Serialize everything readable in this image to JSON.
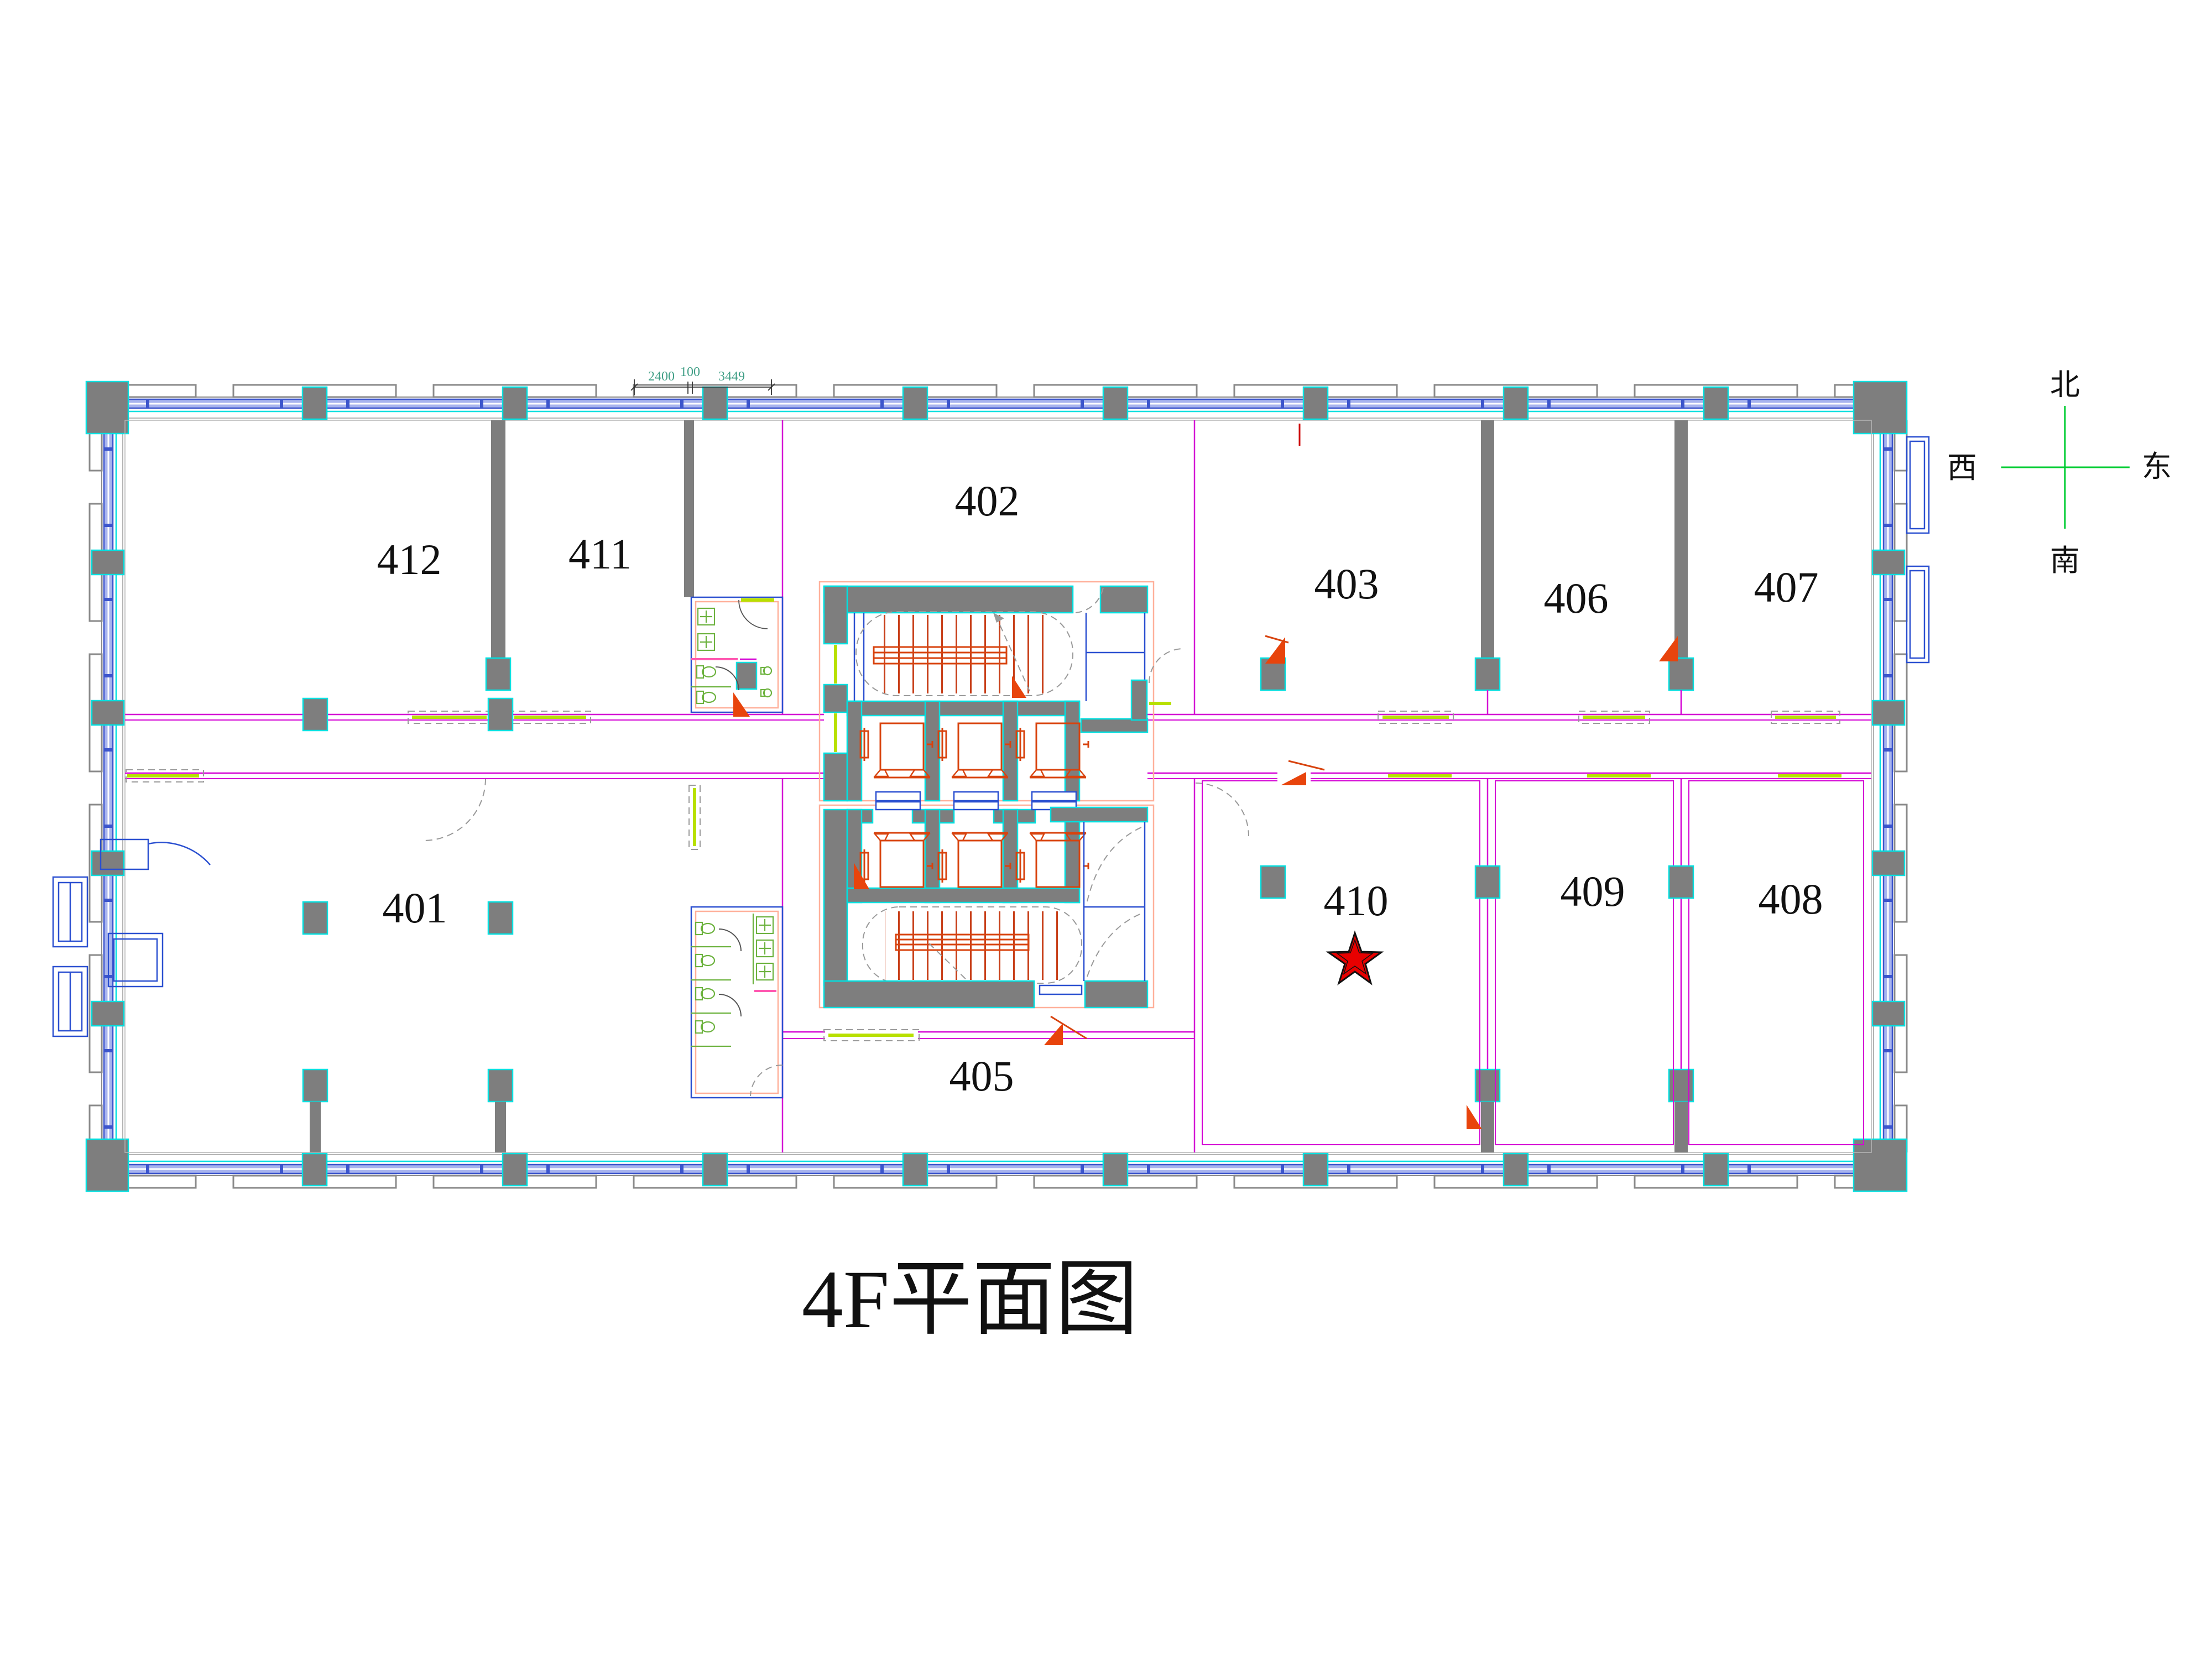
{
  "title": "4F平面图",
  "compass": {
    "north": "北",
    "south": "南",
    "east": "东",
    "west": "西"
  },
  "dimension_labels": {
    "seg1": "2400",
    "seg2": "100",
    "seg3": "3449"
  },
  "rooms": {
    "r401": "401",
    "r402": "402",
    "r403": "403",
    "r405": "405",
    "r406": "406",
    "r407": "407",
    "r408": "408",
    "r409": "409",
    "r410": "410",
    "r411": "411",
    "r412": "412"
  },
  "marker": {
    "type": "star",
    "room": "410",
    "color": "#e80000"
  },
  "colors": {
    "wall_gray": "#7e7e7e",
    "wall_highlight_cyan": "#00e0e0",
    "partition_magenta": "#d400d4",
    "window_blue": "#3c55cc",
    "glass_band_fill": "#a8b4ee",
    "core_outline_salmon": "#ffb09a",
    "stair_elevator_orange": "#d8430e",
    "door_highlight_green": "#b8e000",
    "fixture_green": "#6cb23e",
    "compass_cross_green": "#00cc33",
    "dimension_text_teal": "#3f9e85",
    "star_red": "#e80000"
  }
}
